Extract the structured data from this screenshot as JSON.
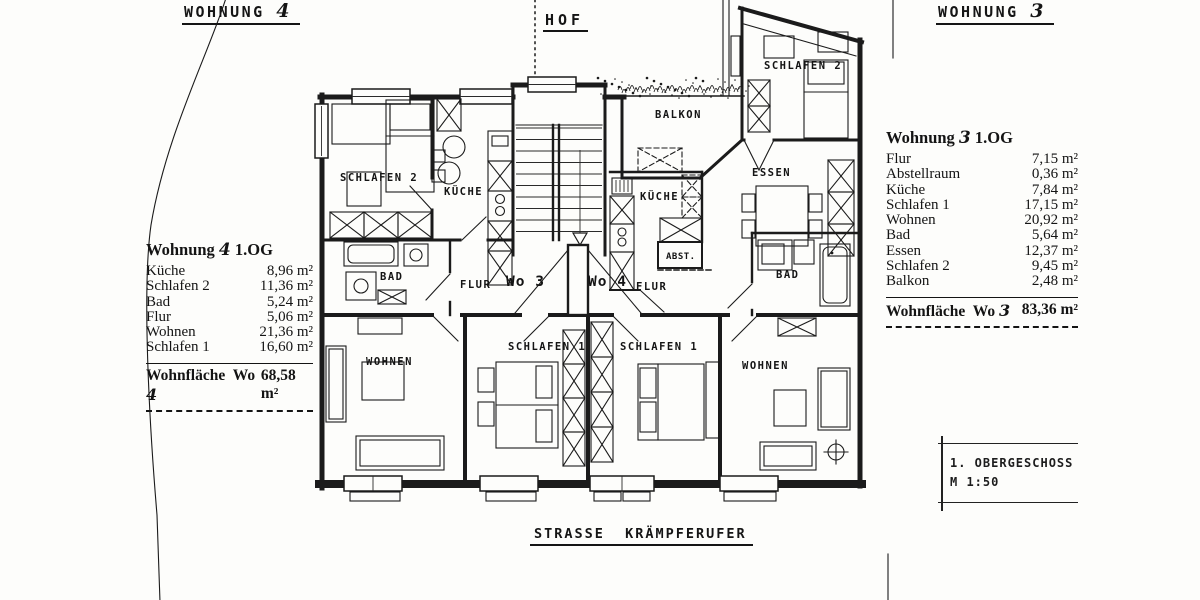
{
  "titles": {
    "left_apartment": "WOHNUNG",
    "left_apartment_num": "4",
    "right_apartment": "WOHNUNG",
    "right_apartment_num": "3",
    "hof": "HOF",
    "street": "STRASSE  KRÄMPFERUFER"
  },
  "plan_labels": {
    "balkon": "BALKON",
    "schlafen2_left": "SCHLAFEN 2",
    "kueche_left": "KÜCHE",
    "bad_left": "BAD",
    "flur_left": "FLUR",
    "wo3": "Wo 3",
    "wo4": "Wo 4",
    "kueche_right": "KÜCHE",
    "abst": "ABST.",
    "flur_right": "FLUR",
    "essen": "ESSEN",
    "bad_right": "BAD",
    "schlafen2_right": "SCHLAFEN 2",
    "wohnen_left": "WOHNEN",
    "schlafen1_left": "SCHLAFEN 1",
    "schlafen1_right": "SCHLAFEN 1",
    "wohnen_right": "WOHNEN"
  },
  "area_table_wo4": {
    "title_prefix": "Wohnung",
    "title_num": "4",
    "title_suffix": "1.OG",
    "rows": [
      {
        "label": "Küche",
        "value": "8,96 m²"
      },
      {
        "label": "Schlafen 2",
        "value": "11,36 m²"
      },
      {
        "label": "Bad",
        "value": "5,24 m²"
      },
      {
        "label": "Flur",
        "value": "5,06 m²"
      },
      {
        "label": "Wohnen",
        "value": "21,36 m²"
      },
      {
        "label": "Schlafen 1",
        "value": "16,60 m²"
      }
    ],
    "total_label": "Wohnfläche  Wo",
    "total_num": "4",
    "total_value": "68,58 m²"
  },
  "area_table_wo3": {
    "title_prefix": "Wohnung",
    "title_num": "3",
    "title_suffix": "1.OG",
    "rows": [
      {
        "label": "Flur",
        "value": "7,15 m²"
      },
      {
        "label": "Abstellraum",
        "value": "0,36 m²"
      },
      {
        "label": "Küche",
        "value": "7,84 m²"
      },
      {
        "label": "Schlafen 1",
        "value": "17,15 m²"
      },
      {
        "label": "Wohnen",
        "value": "20,92 m²"
      },
      {
        "label": "Bad",
        "value": "5,64 m²"
      },
      {
        "label": "Essen",
        "value": "12,37 m²"
      },
      {
        "label": "Schlafen 2",
        "value": "9,45 m²"
      },
      {
        "label": "Balkon",
        "value": "2,48 m²"
      }
    ],
    "total_label": "Wohnfläche  Wo",
    "total_num": "3",
    "total_value": "83,36 m²"
  },
  "title_block": {
    "line1": "1. OBERGESCHOSS",
    "line2": "M 1:50"
  },
  "colors": {
    "ink": "#1b1b1b",
    "paper": "#fdfdfb"
  }
}
